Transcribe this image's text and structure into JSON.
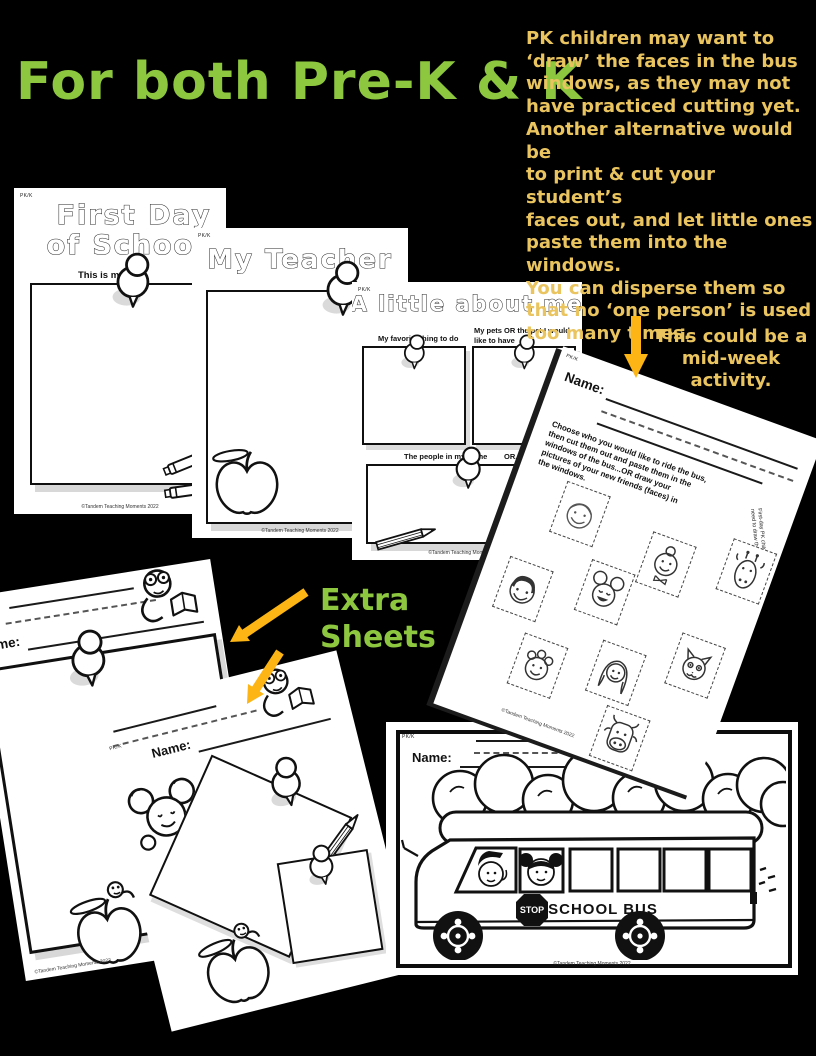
{
  "colors": {
    "background": "#000000",
    "title_green": "#8dc63f",
    "note_gold": "#eac45f",
    "arrow_gold": "#fdb515"
  },
  "header": {
    "title": "For both Pre-K & K"
  },
  "intro_note": {
    "lines": [
      "PK children may want to",
      "‘draw’ the faces in the bus",
      "windows, as they may not",
      "have practiced cutting yet.",
      "Another alternative would be",
      "to print & cut your student’s",
      "faces out, and let little ones",
      "paste them into the windows.",
      "You can disperse them so",
      "that no ‘one person’ is used",
      "too many times."
    ]
  },
  "midweek_note": {
    "lines": [
      "This could be a",
      "mid-week",
      "activity."
    ]
  },
  "extra_sheets_label": {
    "lines": [
      "Extra",
      "Sheets"
    ]
  },
  "common": {
    "corner_label": "PK/K",
    "name_label": "Name:",
    "footer": "©Tandem Teaching Moments 2022"
  },
  "sheets": {
    "first_day": {
      "title_line1": "First Day",
      "title_line2": "of School",
      "subtitle": "This is me!"
    },
    "my_teacher": {
      "title": "My Teacher"
    },
    "about_me": {
      "title": "A little about me",
      "box1_label": "My favorite thing to do",
      "box2_label_line1": "My pets OR the pet I would",
      "box2_label_line2": "like to have",
      "box3_label_left": "The people in my home",
      "box3_label_right": "OR...my family"
    },
    "bus_faces": {
      "instruction_lines": [
        "Choose who you would like to ride the bus,",
        "then cut them out and paste them in the",
        "windows of the bus...OR draw your",
        "pictures of your new friends (faces) in",
        "the windows."
      ],
      "side_note_line1": "First-day PK children",
      "side_note_line2": "need to draw their pictures",
      "faces": [
        "boy-smiling",
        "girl-with-bun",
        "giraffe",
        "mouse",
        "boy-dark-hair",
        "boy-curly-hair",
        "girl-long-hair",
        "cat",
        "cow"
      ]
    },
    "school_bus": {
      "stop_sign": "STOP",
      "bus_label": "SCHOOL BUS"
    }
  },
  "decorations": [
    "pushpin",
    "crayon",
    "apple",
    "worm",
    "bookworm",
    "mouse",
    "pencil",
    "trees",
    "school-bus",
    "stop-sign",
    "down-arrow",
    "diagonal-arrows"
  ]
}
